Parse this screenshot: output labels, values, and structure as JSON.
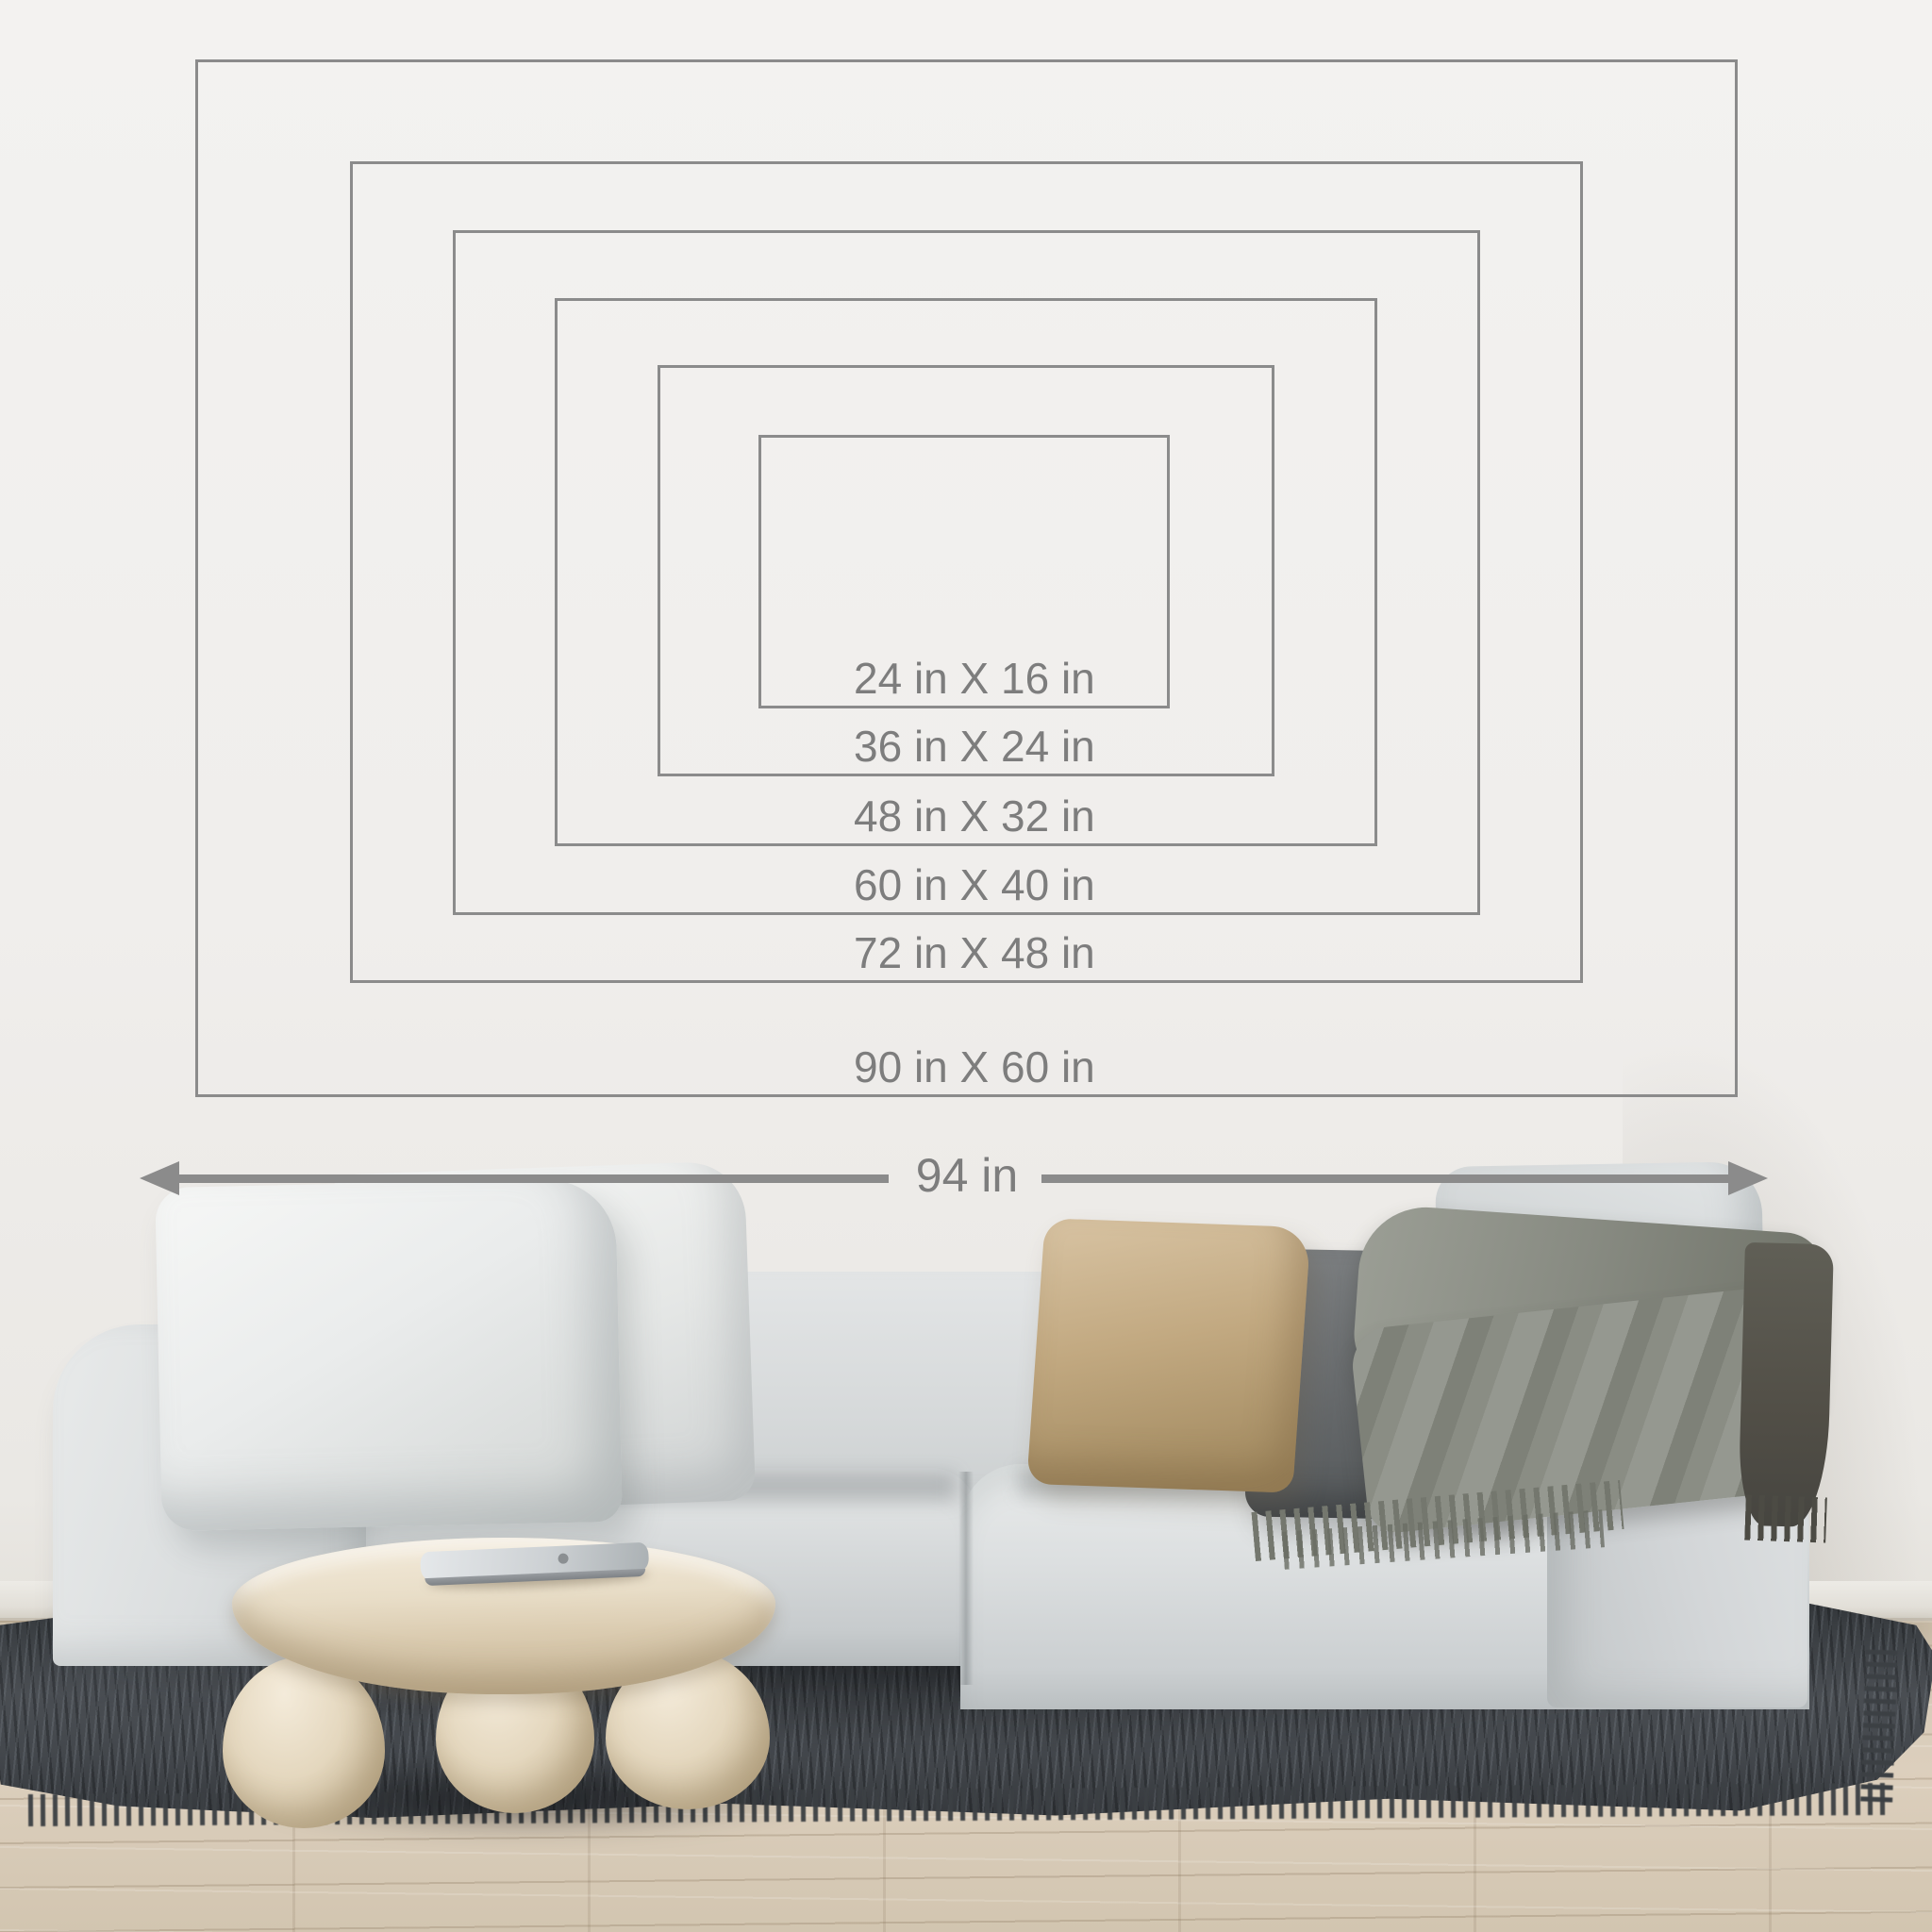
{
  "size_guide": {
    "sizes": [
      {
        "label": "24 in X 16 in",
        "width_in": 24,
        "height_in": 16
      },
      {
        "label": "36 in X 24 in",
        "width_in": 36,
        "height_in": 24
      },
      {
        "label": "48 in X 32 in",
        "width_in": 48,
        "height_in": 32
      },
      {
        "label": "60 in X 40 in",
        "width_in": 60,
        "height_in": 40
      },
      {
        "label": "72 in X 48 in",
        "width_in": 72,
        "height_in": 48
      },
      {
        "label": "90 in X 60 in",
        "width_in": 90,
        "height_in": 60
      }
    ],
    "overall_width": {
      "label": "94 in",
      "value_in": 94
    }
  },
  "colors": {
    "guide_line": "#8b8b8b",
    "guide_text": "#7d7d7d",
    "wall": "#f1efed",
    "floor_wood": "#d8ccba",
    "rug": "#43474b",
    "sofa_fabric": "#d7dadb",
    "pillow_white": "#edefee",
    "pillow_beige": "#c2a981",
    "pillow_dark_gray": "#67696b",
    "pillow_light_gray": "#d3d6d7",
    "throw_blanket": "#8b8e84",
    "table_stone": "#e8dcc6"
  }
}
